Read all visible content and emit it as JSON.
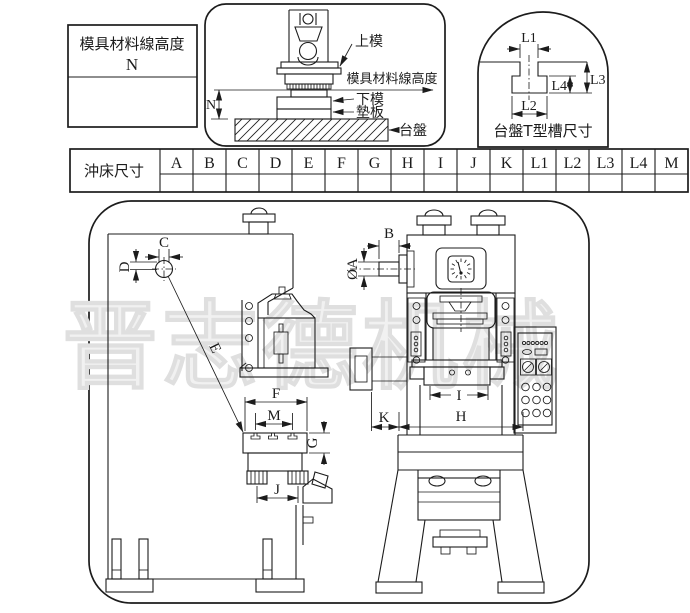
{
  "colors": {
    "line": "#1c1c1c",
    "background": "#ffffff",
    "watermark": "#f1f1f1"
  },
  "legend_box": {
    "title": "模具材料線高度",
    "symbol": "N"
  },
  "die_assembly_panel": {
    "labels": {
      "upper_die": "上模",
      "material_line_height": "模具材料線高度",
      "lower_die": "下模",
      "backing_plate": "墊板",
      "bolster_table": "台盤",
      "height_dim": "N"
    }
  },
  "tslot_panel": {
    "caption": "台盤T型槽尺寸",
    "dims": {
      "l1": "L1",
      "l2": "L2",
      "l3": "L3",
      "l4": "L4"
    }
  },
  "size_table": {
    "row_label": "沖床尺寸",
    "columns": [
      "A",
      "B",
      "C",
      "D",
      "E",
      "F",
      "G",
      "H",
      "I",
      "J",
      "K",
      "L1",
      "L2",
      "L3",
      "L4",
      "M"
    ],
    "values": [
      "",
      "",
      "",
      "",
      "",
      "",
      "",
      "",
      "",
      "",
      "",
      "",
      "",
      "",
      "",
      ""
    ]
  },
  "machine_drawing": {
    "watermark": "晋志德机械",
    "side_view": {
      "dims": {
        "c": "C",
        "d": "D",
        "e": "E",
        "f": "F",
        "m": "M",
        "g": "G",
        "j": "J"
      }
    },
    "front_view": {
      "dims": {
        "b": "B",
        "diameter_a": "ØA",
        "i": "I",
        "k": "K",
        "h": "H"
      }
    }
  }
}
